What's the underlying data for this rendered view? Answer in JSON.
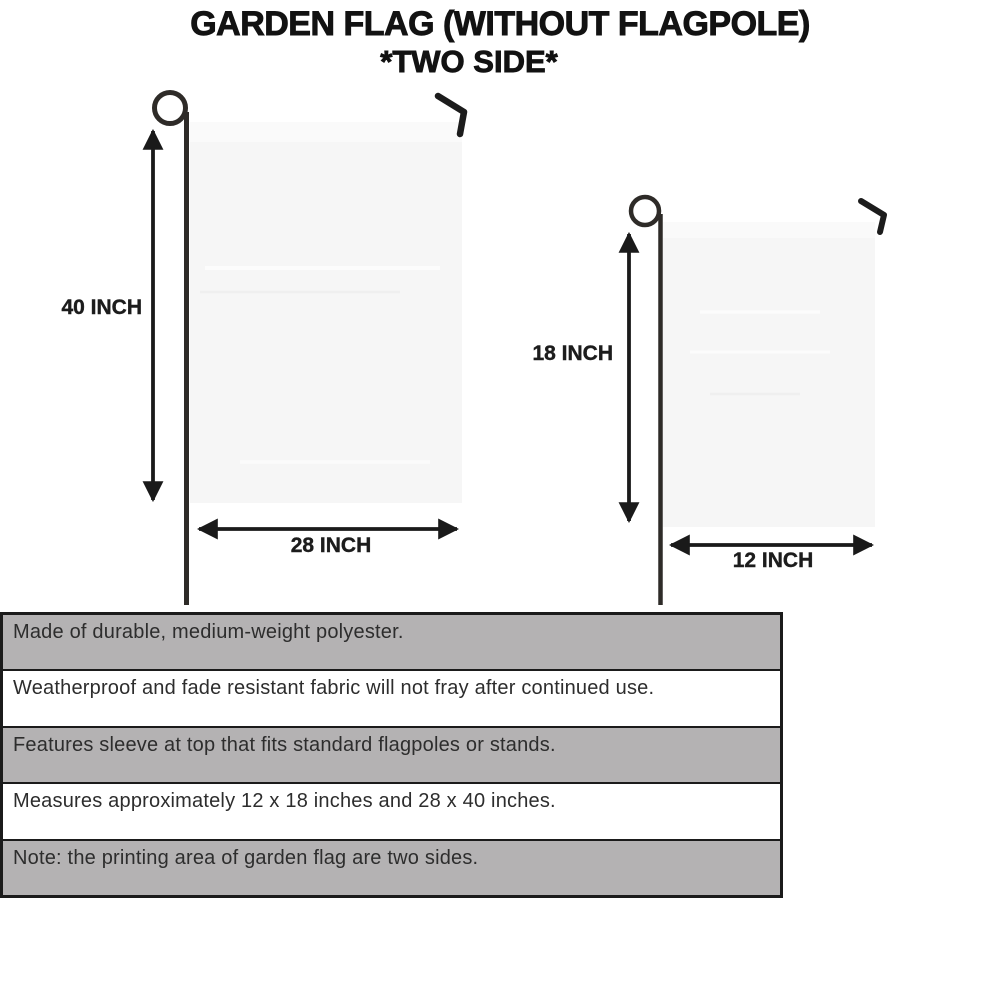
{
  "title": {
    "line1": "GARDEN FLAG (WITHOUT FLAGPOLE)",
    "line2": "*TWO SIDE*"
  },
  "flags": {
    "large": {
      "height_label": "40 INCH",
      "width_label": "28 INCH"
    },
    "small": {
      "height_label": "18 INCH",
      "width_label": "12 INCH"
    }
  },
  "features": [
    "Made of durable, medium-weight polyester.",
    "Weatherproof and fade resistant fabric will not fray after continued use.",
    "Features sleeve at top that fits standard flagpoles or stands.",
    "Measures approximately 12 x 18 inches and 28 x 40 inches.",
    "Note: the printing area of garden flag are two sides."
  ],
  "colors": {
    "background": "#ffffff",
    "ink": "#1b1b1b",
    "pole": "#2e2b28",
    "flag_fill": "#f6f6f6",
    "table_row_gray": "#b4b2b3",
    "table_row_white": "#ffffff",
    "table_text": "#2d2d2d"
  }
}
